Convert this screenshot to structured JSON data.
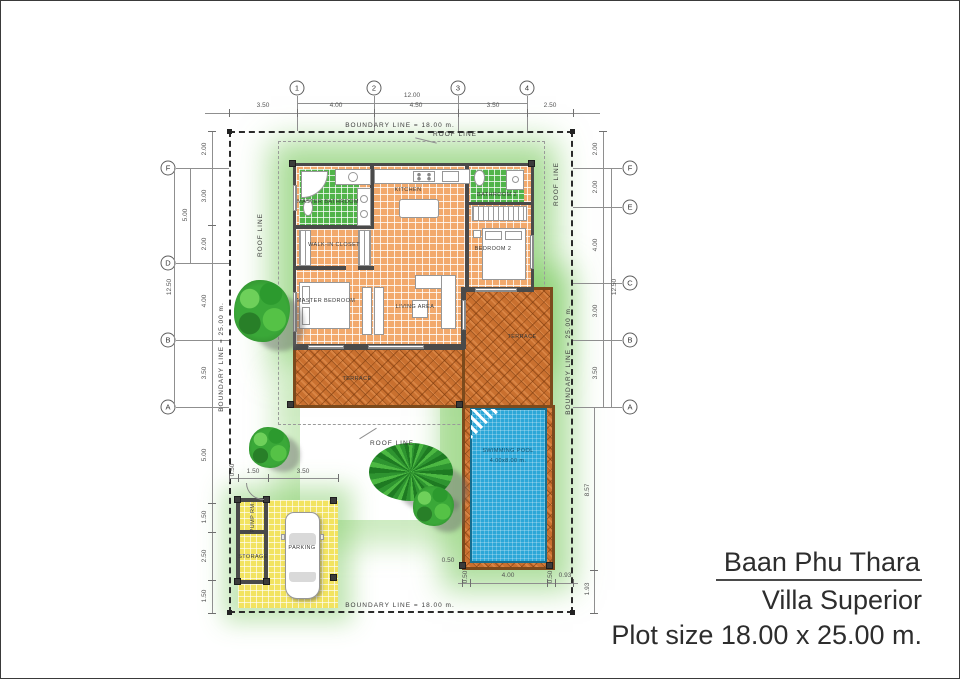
{
  "title_block": {
    "name": "Baan Phu Thara",
    "model": "Villa Superior",
    "plot": "Plot size 18.00 x 25.00 m."
  },
  "boundary_labels": {
    "top": "BOUNDARY LINE = 18.00 m.",
    "bottom": "BOUNDARY LINE = 18.00 m.",
    "left": "BOUNDARY LINE = 25.00 m.",
    "right": "BOUNDARY LINE = 25.00 m."
  },
  "roof_label": "ROOF LINE",
  "grid_markers": {
    "top": [
      "1",
      "2",
      "3",
      "4"
    ],
    "left": [
      "F",
      "D",
      "B",
      "A"
    ],
    "right": [
      "F",
      "E",
      "C",
      "B",
      "A"
    ]
  },
  "dims": {
    "top_chain": [
      "3.50",
      "4.00",
      "4.50",
      "3.50",
      "2.50"
    ],
    "top_overall": "12.00",
    "left_upper": [
      "2.00",
      "3.00",
      "2.00",
      "4.00",
      "3.50"
    ],
    "left_group": "5.00",
    "left_overall": "12.50",
    "left_lower": [
      "5.00",
      "1.50",
      "2.50",
      "1.50"
    ],
    "right_upper": [
      "2.00",
      "2.00",
      "4.00",
      "3.00",
      "3.50"
    ],
    "right_overall": "12.50",
    "right_lower": [
      "8.57",
      "1.93"
    ],
    "garage_top": [
      "0.50",
      "1.50",
      "3.50"
    ],
    "pool_bottom": [
      "0.50",
      "4.00",
      "0.50",
      "0.93"
    ],
    "pool_left": "0.50"
  },
  "rooms": {
    "master_bathroom": "MASTER BATHROOM",
    "kitchen": "KITCHEN",
    "bathroom2": "BATHROOM 2",
    "walk_in_closet": "WALK-IN CLOSET",
    "bedroom2": "BEDROOM 2",
    "master_bedroom": "MASTER BEDROOM",
    "living_area": "LIVING AREA",
    "terrace_main": "TERRACE",
    "terrace_side": "TERRACE",
    "pump_room": "PUMP RM.",
    "storage": "STORAGE",
    "parking": "PARKING"
  },
  "pool": {
    "label": "SWIMMING POOL",
    "size": "4.00x8.00 m."
  },
  "colors": {
    "floor_tile": "#f2a96c",
    "terrace": "#c9702f",
    "terrace_border": "#7c4a1c",
    "pool_water": "#2ca7d8",
    "bath_tile": "#51b44a",
    "garage_tile": "#f2e360",
    "wall": "#4a4a4a",
    "garden_glow": "#78c45e"
  }
}
